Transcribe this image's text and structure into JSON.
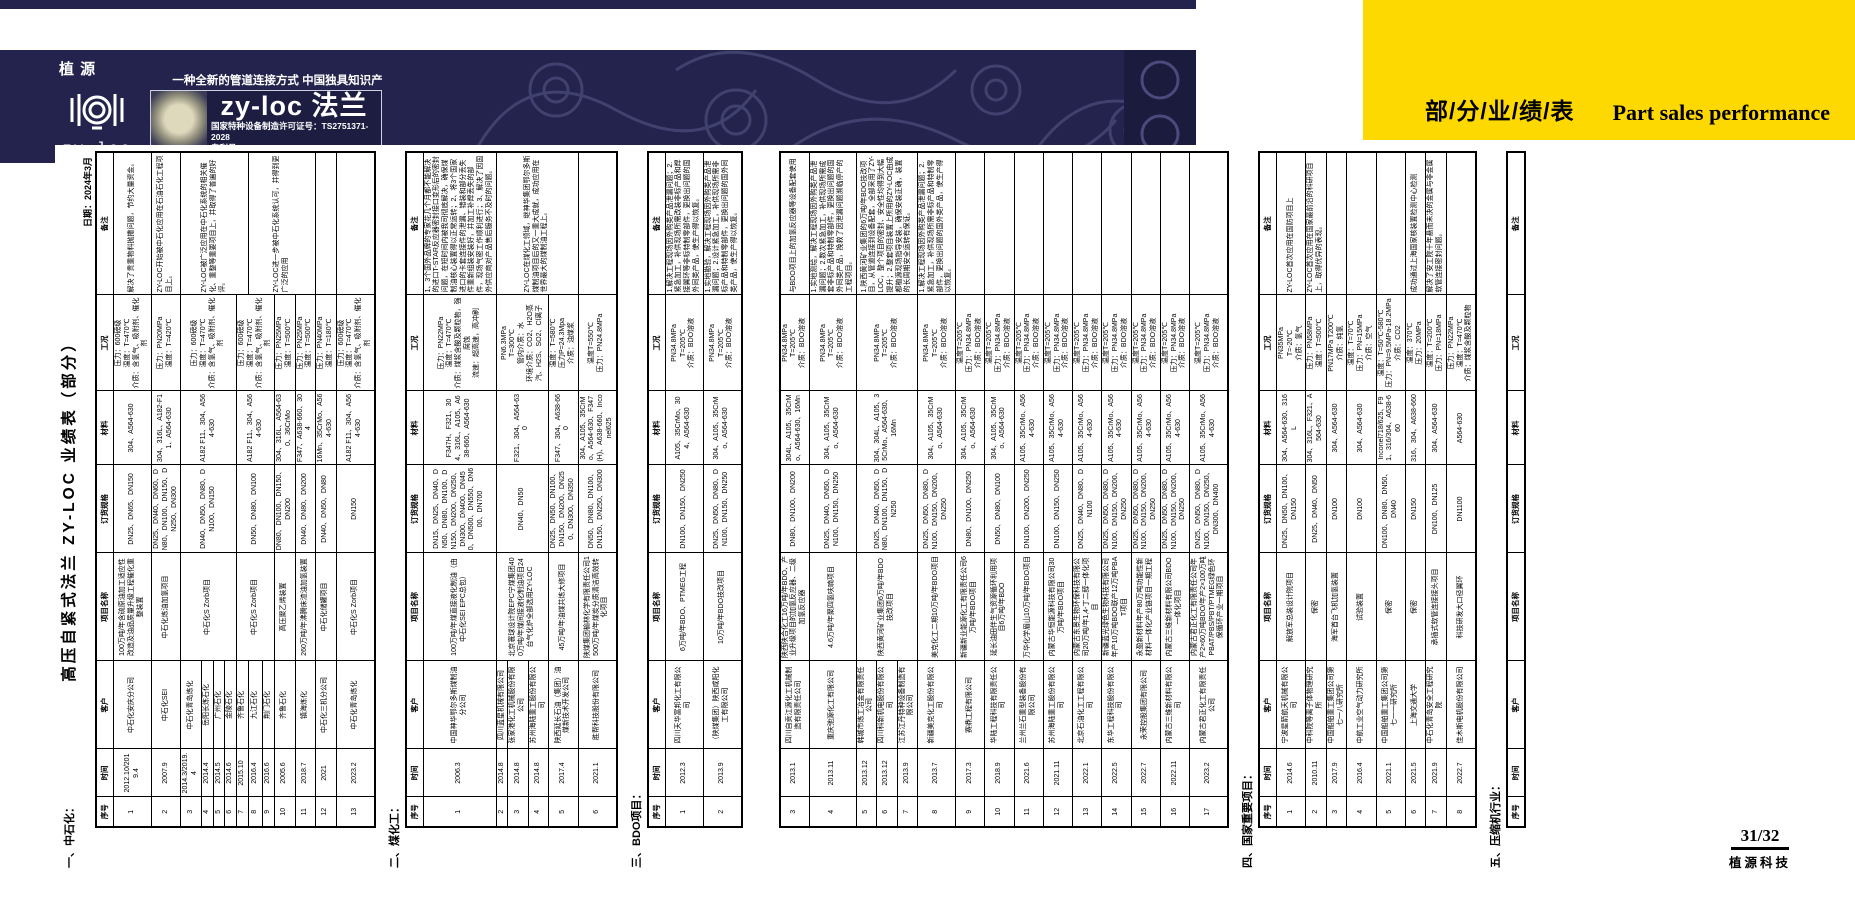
{
  "banner": {
    "bg_color": "#23234d",
    "logo_top": "植  源",
    "logo_bottom": "zy-loc",
    "slogan": "一种全新的管道连接方式  中国独具知识产权的产品",
    "brand_title": "zy-loc 法兰",
    "license": "国家特种设备制造许可证号：TS2751371-2028",
    "patent": "专利号：  ZL 201611044305/201621266581"
  },
  "tab": {
    "bg_color": "#fed801",
    "cn": "部/分/业/绩/表",
    "en": "Part sales performance"
  },
  "doc": {
    "title": "高压自紧式法兰 ZY-LOC 业绩表（部分）",
    "date": "日期：2024年3月",
    "headers": [
      "序号",
      "时间",
      "客户",
      "项目名称",
      "订货规格",
      "材料",
      "工况",
      "备注"
    ],
    "col_widths": [
      30,
      48,
      88,
      108,
      88,
      74,
      96,
      143
    ],
    "sections": [
      {
        "label": "一、中石化：",
        "rows": [
          [
            "1",
            "2012.10/2019.4",
            "中石化安庆分公司",
            "100万吨/年含硫原油加工适应性改造及油品质量升级工程催化重整装置",
            "DN25、DN65、DN150",
            "304、A564-630",
            "压力：600磅级\n温度：T=470℃\n介质：含氢气、吸附剂、催化剂",
            "解决了贵重物料抛撒问题，节约大量资金。"
          ],
          [
            "2",
            "2007.9",
            "中石化SEI",
            "中石化炼油加氢项目",
            "DN25、DN40、DN60、DN80、DN100、DN150、DN250、DN300",
            "304、316L、A182-F11、A564-630",
            "压力：PN20MPa\n温度：T=420℃",
            "ZY-LOC开始被中石化应用在石油石化工程项目上。"
          ],
          [
            "3",
            "2014.3/2019.4",
            "中石化青岛炼化",
            {
              "v": "中石化S Zorb项目",
              "rs": 4
            },
            {
              "v": "DN40、DN50、DN80、DN100、DN150",
              "rs": 4
            },
            {
              "v": "A182 F11、304、A564-630",
              "rs": 4
            },
            {
              "v": "压力：600磅级\n温度：T=470℃\n介质：含氢气、吸附剂、催化剂",
              "rs": 4
            },
            {
              "v": "ZY-LOC被广泛应用在中石化系统的相关催化、重整等重要项目上，并取得了普遍的好评。",
              "rs": 5
            }
          ],
          [
            "4",
            "2014.4",
            "岳阳长炼石化",
            null,
            null,
            null,
            null,
            null
          ],
          [
            "5",
            "2014.5",
            "广州石化",
            null,
            null,
            null,
            null,
            null
          ],
          [
            "6",
            "2014.6",
            "金陵石化",
            null,
            null,
            null,
            null,
            null
          ],
          [
            "7",
            "2015.10",
            "齐鲁石化",
            {
              "v": "中石化S Zorb项目",
              "rs": 3
            },
            {
              "v": "DN50、DN80、DN100",
              "rs": 3
            },
            {
              "v": "A182 F11、304、A564-630",
              "rs": 3
            },
            {
              "v": "压力：600磅级\n温度：T=470℃\n介质：含氢气、吸附剂、催化剂",
              "rs": 3
            },
            null
          ],
          [
            "8",
            "2016.4",
            "九江石化",
            null,
            null,
            null,
            null,
            {
              "v": "ZY-LOC进一步被中石化系统认可，并得到更广泛的应用",
              "rs": 4
            }
          ],
          [
            "9",
            "2016.6",
            "荆门石化",
            null,
            null,
            null,
            null,
            null
          ],
          [
            "10",
            "2005.6",
            "齐鲁石化",
            "高压聚乙烯装置",
            "DN80、DN100、DN150、DN200",
            "304、316L、A564-630、36CrMo",
            "压力：PN25MPa\n温度：T=500℃",
            null
          ],
          [
            "11",
            "2018.7",
            "镇海炼化",
            "260万吨/年沸腾床渣油加氢装置",
            "DN40、DN80、DN200",
            "F347、A638-660、304",
            "压力：PN25MPa\n温度：T=500℃",
            null
          ],
          [
            "12",
            "2021",
            "中石化三机分公司",
            "中石化储罐项目",
            "DN40、DN50、DN80",
            "16Mn、35CrMo、A564-630",
            "压力：PN40MPa\n温度：T=180℃",
            ""
          ],
          [
            "13",
            "2023.2",
            "中石化青岛炼化",
            "中石化S Zorb项目",
            "DN150",
            "A182 F11、304、A564-630",
            "压力：600磅级\n温度：T=470℃\n介质：含氢气、吸附剂、催化剂",
            ""
          ]
        ]
      },
      {
        "label": "二、煤化工：",
        "rows": [
          [
            "1",
            "2006.3",
            "中国神华鄂尔多斯煤制油分公司",
            "100万吨/年煤直接液化制油（由中石化SEI EPC总包）",
            "DN15、DN25、DN40、DN50、DN80、DN100、DN150、DN200、DN250、DN300、DN400、DN450、DN500、DN550、DN600、DN700",
            "F347H、F321、304、316L、A105、A638-660、A564-630",
            "压力：PN22MPa\n温度：T=470℃\n介质：煤浆含酸及颗粒物，强腐蚀\n流速：超高速，高冲刷",
            "1、3个国外品牌的专家花几个月都不能解决的进口T-STAR反应器密封接口变形后的密封问题，在短时间内被我司彻底解决，确保煤制油核心装置得以正常运转；2、将3个国家进口的卡套连接件的泄漏、错装和部分丢失件重新组装安装好，并加工补焊丢失的部件，现场气密工作顺利进行；3、解决了因国外供应商对产品售后服务不及时的问题。"
          ],
          [
            "2",
            "2014.8",
            "四川蓝星机械有限公司",
            {
              "v": "北京寰球设计院EPC宁煤集团400万吨/年煤间接液化制油项目24台气化炉全部选用ZY-LOC",
              "rs": 3
            },
            {
              "v": "DN40、DN50",
              "rs": 3
            },
            {
              "v": "F321、304、A564-630",
              "rs": 3
            },
            {
              "v": "PN6.3MPa\nT=300℃\n管内介质：水\n环境介质：CO2、H2O蒸汽、H2S、SO2、Cl离子",
              "rs": 3
            },
            {
              "v": "ZY-LOC在煤化工领域，继神华集团鄂尔多斯煤制油项目后的又一重大成就，成功应用在世界最大的煤制油工程上。",
              "rs": 4
            }
          ],
          [
            "3",
            "2014.8",
            "张家港化工机械股份有限公司",
            null,
            null,
            null,
            null,
            null
          ],
          [
            "4",
            "2014.8",
            "苏州海陆重工股份有限公司",
            null,
            null,
            null,
            null,
            null
          ],
          [
            "5",
            "2017.4",
            "陕西延长石油（集团）油煤新技术开发公司",
            "45万吨/年油煤共炼大修项目",
            "DN25、DN50、DN100、DN150、DN200、DN250、DN300、DN350",
            "F347、304、A638-660",
            "温度：T=580℃\n压力P=24.3Mpa\n介质：油煤浆",
            null
          ],
          [
            "6",
            "2021.1",
            "胜帮科技股份有限公司",
            "陕煤集团榆林化学有限责任公司1500万吨/年煤炭分质清洁高效转化项目",
            "DN50、DN80、DN100、DN150、DN250、DN300",
            "304、A105、35CrMo、A564-630、F347(H)、A638-660、Inconel625",
            "温度T=550℃\n压力：PN24.8MPa",
            ""
          ]
        ]
      },
      {
        "label": "三、BDO项目：",
        "split_after": 2,
        "rows": [
          [
            "1",
            "2012.3",
            "四川天华富邦化工有限公司",
            "6万吨/年BDO、PTMEG工程",
            "DN100、DN150、DN250",
            "A105、35CrMo、304、A564-630",
            "PN34.8MPa\nT=205℃\n介质：BDO溶液",
            "1.解决工程现场因外购类产品泄漏问题；2.紧急加工，补供现场所需改装非标产品和焊接翼环等非标特制零部件，更换出问题的国外同类产品，使生产得以恢复。"
          ],
          [
            "2",
            "2013.9",
            "（陕煤集团）陕西咸阳化工有限公司",
            "10万吨/年BDO技改项目",
            "DN25、DN50、DN80、DN100、DN150、DN250",
            "304、A105、35CrMo、A564-630",
            "PN34.8MPa\nT=205℃\n介质：BDO溶液",
            "1.实地勘验，解决工程现场因外购类产品泄漏问题；2.设计紧急加工，补供现场所需非标产品和特制零部件，更换出问题的国外同类产品，使生产得以恢复。"
          ],
          [
            "3",
            "2013.1",
            "四川自贡江源化工机械制造有限责任公司",
            "陕西陕合化工16万吨/年BDO、产业升级项目的加氢反应器、二级加氢反应器",
            "DN80、DN100、DN200",
            "304L、A105、35CrMo、A564-630、16Mn",
            "PN34.8MPa\nT=205℃\n介质：BDO溶液",
            "与BDO项目上的加氢反应器等设备配套使用"
          ],
          [
            "4",
            "2013.11",
            "重庆弛源化工有限公司",
            "4.6万吨/年聚四氢呋喃项目",
            "DN25、DN40、DN50、DN100、DN150、DN250",
            "304、A105、35CrMo、A564-630",
            "PN34.8MPa\nT=205℃\n介质：BDO溶液",
            "1.实地测绘，解决工程现场因外购类产品泄漏问题；2.数次紧急加工，补供现场所需成套非标产品和特制零部件，更换出问题的国外同类产品，挽救了因泄漏问题濒临停产的工程项目。"
          ],
          [
            "5",
            "2013.12",
            "韩城市炼工冶金有限责任公司",
            {
              "v": "陕西黄河矿业集团6万吨/年BDO技改项目",
              "rs": 3
            },
            {
              "v": "DN25、DN40、DN50、DN80、DN100、DN150、DN250",
              "rs": 3
            },
            {
              "v": "304、304L、A105、35CrMo、A564-630、16Mn",
              "rs": 3
            },
            {
              "v": "PN34.8MPa\nT=205℃\n介质：BDO溶液",
              "rs": 3
            },
            {
              "v": "1.陕西黄河矿业集团的6万吨/年BDO技改项目，从管道连接到设备配套，全部采用了ZY-LOC，整个项目的密封、安全性均得到大幅提升；2.整套项目装置上所用的ZY-LOC由成都植源现场指导安装，确保安装正确，装置的长周期安全运转有保证。",
              "rs": 3
            }
          ],
          [
            "6",
            "2013.12",
            "四川科新机电股份有限公司",
            null,
            null,
            null,
            null,
            null
          ],
          [
            "7",
            "2013.9",
            "江苏江丹特种设备制造有限公司",
            null,
            null,
            null,
            null,
            null
          ],
          [
            "8",
            "2013.7",
            "新疆美克化工股份有限公司",
            "美克化工二期10万吨/年BDO项目",
            "DN25、DN50、DN80、DN100、DN150、DN200、DN250",
            "304、A105、35CrMo、A564-630",
            "PN34.8MPa\nT=205℃\n介质：BDO溶液",
            "1.解决工程现场因外购类产品泄漏问题；2.紧急加工，补供现场所需非标产品和特制零部件，更换出问题的国外类产品，使生产得以恢复。"
          ],
          [
            "9",
            "2017.3",
            "赛鼎工程有限公司",
            "新疆新业能源化工有限责任公司6万吨/年BDO项目",
            "DN80、DN100、DN250",
            "304、A105、35CrMo、A564-630",
            "温度T=205℃\n压力：PN34.8MPa\n介质：BDO溶液",
            ""
          ],
          [
            "10",
            "2018.9",
            "华陆工程科技有限责任公司",
            "延长油田伴生气资源循环利用项目6万吨/年BDO",
            "DN50、DN80、DN100",
            "304、A105、35CrMo、A564-630",
            "温度T=205℃\n压力：PN34.8MPa\n介质：BDO溶液",
            ""
          ],
          [
            "11",
            "2021.6",
            "兰州兰石重型装备股份有限公司",
            "万华化学眉山10万吨/年BDO项目",
            "DN100、DN200、DN250",
            "A105、35CrMo、A564-630",
            "温度T=205℃\n压力：PN34.8MPa\n介质：BDO溶液",
            ""
          ],
          [
            "12",
            "2021.11",
            "苏州海陆重工股份有限公司",
            "内蒙古华恒能源科技有限公司30万吨/年BDO项目",
            "DN100、DN150、DN250",
            "A105、35CrMo、A564-630",
            "温度T=205℃\n压力：PN34.8MPa\n介质：BDO溶液",
            ""
          ],
          [
            "13",
            "2022.1",
            "北京石油化工工程有限公司",
            "内蒙古东景生物环保科技有限公司20万吨/年1,4-丁二醇一体化项目",
            "DN25、DN40、DN80、DN100",
            "A105、35CrMo、A564-630",
            "温度T=205℃\n压力：PN34.8MPa\n介质：BDO溶液",
            ""
          ],
          [
            "14",
            "2022.5",
            "东华工程科技股份有限公司",
            "新疆蓝光绿色生物科技有限公司年产10万吨BDO联产12万吨PBAT项目",
            "DN25、DN50、DN80、DN100、DN150、DN200、DN250",
            "A105、35CrMo、A564-630",
            "温度T=205℃\n压力：PN34.8MPa\n介质：BDO溶液",
            ""
          ],
          [
            "15",
            "2022.7",
            "永荣控股集团有限公司",
            "永盈新材料年产80万吨功能性新材料一体化产业链项目一期工程",
            "DN25、DN50、DN80、DN100、DN150、DN200、DN250",
            "A105、35CrMo、A564-630",
            "温度T=205℃\n压力：PN34.8MPa\n介质：BDO溶液",
            ""
          ],
          [
            "16",
            "2022.11",
            "内蒙古三维新材料有限公司",
            "内蒙古三维新材料有限公司BDO一体化项目",
            "DN25、DN50、DN80、DN100、DN150、DN200、DN250",
            "A105、35CrMo、A564-630",
            "温度T=205℃\n压力：PN34.8MPa\n介质：BDO溶液",
            ""
          ],
          [
            "17",
            "2023.2",
            "内蒙古君正化工有限责任公司",
            "内蒙古君正化工有限责任公司年产2×60万吨BDO/年产2×100万吨PBAT/PBS/PBT/PTMEG绿色环保循环产业一期项目",
            "DN25、DN50、DN80、DN100、DN150、DN250、DN300、DN400",
            "A105、35CrMo、A564-630",
            "温度T=205℃\n压力：PN34.8MPa\n介质：BDO溶液",
            ""
          ]
        ]
      },
      {
        "label": "四、国家重要项目：",
        "rows": [
          [
            "1",
            "2014.6",
            "宁波星箭航天机械有限公司",
            "解放军总装设计院项目",
            "DN25、DN50、DN100、DN150",
            "304、A564-630、316L",
            "PN35MPa\nT=-20℃\n介质：氢气",
            "ZY-LOC首次应用在国防项目上"
          ],
          [
            "2",
            "2010.11",
            "中科院等离子体物理研究所",
            "保密",
            "DN25、DN40、DN50",
            "304、316L、F321、A564-630",
            "压力：PN58MPa\n温度：T=500℃",
            "ZY-LOC首次应用在国家最前沿的科研项目上，取得优异的表现。"
          ],
          [
            "3",
            "2017.9",
            "中国船舶重工集团公司第七一八研究所",
            "海军首台飞机加氢装置",
            "DN100",
            "304、A564-630",
            "PN17MPa T200℃\n介质：纯氢",
            ""
          ],
          [
            "4",
            "2016.4",
            "中航工业空气动力研究所",
            "试验装置",
            "DN100",
            "304、A564-630",
            "温度：T=70℃\n压力：PN=15MPa\n介质：空气",
            ""
          ],
          [
            "5",
            "2021.1",
            "中国船舶重工集团公司第七一一研究所",
            "保密",
            "DN100、DN80、DN50、DN40",
            "Inconel718/625、F91、316/304、A638-660",
            "温度：T=50℃-580℃\n压力：PN=9.5MPa-18.2MPa\n介质：CO2",
            ""
          ],
          [
            "6",
            "2021.5",
            "上海交通大学",
            "保密",
            "DN150",
            "316、304、A638-660",
            "温度：370℃\n压力：20MPa",
            "成功通过上海国家核装置检测中心检测"
          ],
          [
            "7",
            "2021.9",
            "中石化青岛安全工程研究院",
            "承插式软管连接接头项目",
            "DN100、DN125",
            "304、A564-630",
            "温度：T=200℃\n压力：PN=18MPa",
            "解决了安工院十年悬而未决的金属与非金属软管连接密封问题。"
          ],
          [
            "8",
            "2022.7",
            "佳木斯电机股份有限公司",
            "科技研发大口径翼环",
            "DN1100",
            "A564-630",
            "压力：PN22MPa\n温度：T=470℃\n介质：煤浆含酸及颗粒物",
            ""
          ]
        ]
      },
      {
        "label": "五、压缩机行业：",
        "rows": []
      }
    ]
  },
  "footer": {
    "page": "31/32",
    "company": "植源科技"
  }
}
